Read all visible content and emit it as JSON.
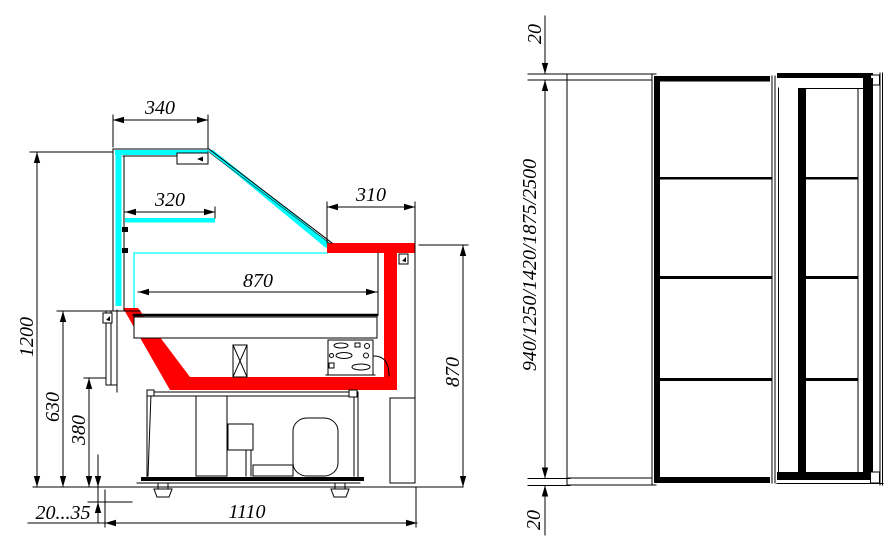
{
  "drawing": {
    "colors": {
      "glass_accent": "#00FFFF",
      "highlight_accent": "#FF0000",
      "line": "#000000",
      "background": "#FFFFFF"
    },
    "section_view": {
      "dims": {
        "canopy_width": "340",
        "shelf_width": "320",
        "worktop_width": "310",
        "interior_width": "870",
        "overall_height": "1200",
        "front_panel_height": "630",
        "base_height": "380",
        "leg_adjust_range": "20...35",
        "base_width": "1110",
        "worktop_height": "870"
      }
    },
    "front_view": {
      "dims": {
        "top_gap": "20",
        "case_lengths": "940/1250/1420/1875/2500",
        "bottom_gap": "20"
      }
    }
  }
}
